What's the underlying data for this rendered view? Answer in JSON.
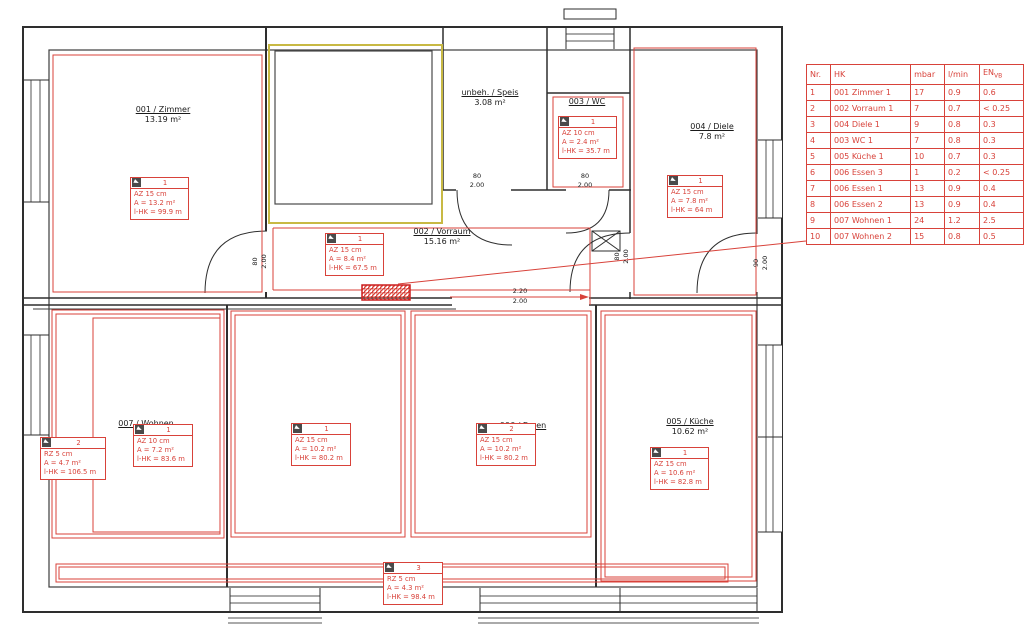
{
  "colors": {
    "annotation_red": "#d8423a",
    "unheated_yellow": "#c8b944",
    "wall_dark": "#2e2e2e"
  },
  "rooms": {
    "zimmer": {
      "name": "001 / Zimmer",
      "area": "13.19 m²"
    },
    "speis": {
      "name": "unbeh. / Speis",
      "area": "3.08 m²"
    },
    "wc": {
      "name": "003 / WC"
    },
    "diele": {
      "name": "004 / Diele",
      "area": "7.8 m²"
    },
    "vorraum": {
      "name": "002 / Vorraum",
      "area": "15.16 m²"
    },
    "wohnen": {
      "name": "007 / Wohnen"
    },
    "essen": {
      "name": "006 / Essen"
    },
    "kueche": {
      "name": "005 / Küche",
      "area": "10.62 m²"
    }
  },
  "hk_boxes": [
    {
      "no": "1",
      "line1": "AZ 15 cm",
      "line2": "A = 13.2 m²",
      "line3": "l-HK = 99.9 m"
    },
    {
      "no": "1",
      "line1": "AZ 10 cm",
      "line2": "A = 2.4 m²",
      "line3": "l-HK = 35.7 m"
    },
    {
      "no": "1",
      "line1": "AZ 15 cm",
      "line2": "A = 7.8 m²",
      "line3": "l-HK = 64 m"
    },
    {
      "no": "1",
      "line1": "AZ 15 cm",
      "line2": "A = 8.4 m²",
      "line3": "l-HK = 67.5 m"
    },
    {
      "no": "2",
      "line1": "RZ 5 cm",
      "line2": "A = 4.7 m²",
      "line3": "l-HK = 106.5 m"
    },
    {
      "no": "1",
      "line1": "AZ 10 cm",
      "line2": "A = 7.2 m²",
      "line3": "l-HK = 83.6 m"
    },
    {
      "no": "1",
      "line1": "AZ 15 cm",
      "line2": "A = 10.2 m²",
      "line3": "l-HK = 80.2 m"
    },
    {
      "no": "2",
      "line1": "AZ 15 cm",
      "line2": "A = 10.2 m²",
      "line3": "l-HK = 80.2 m"
    },
    {
      "no": "1",
      "line1": "AZ 15 cm",
      "line2": "A = 10.6 m²",
      "line3": "l-HK = 82.8 m"
    },
    {
      "no": "3",
      "line1": "RZ 5 cm",
      "line2": "A = 4.3 m²",
      "line3": "l-HK = 98.4 m"
    }
  ],
  "dims": {
    "speis_door": {
      "w": "80",
      "h": "2.00"
    },
    "wc_door": {
      "w": "80",
      "h": "2.00"
    },
    "zimmer_door": {
      "w": "80",
      "h": "2.00"
    },
    "diele_door": {
      "w": "80",
      "h": "2.00"
    },
    "entry_door": {
      "w": "90",
      "h": "2.00"
    },
    "passage": {
      "w": "2.20",
      "h": "2.00"
    }
  },
  "hk_table": {
    "headers": {
      "nr": "Nr.",
      "hk": "HK",
      "mbar": "mbar",
      "lmin": "l/min",
      "en_main": "EN",
      "en_sub": "VB"
    },
    "rows": [
      {
        "c0": "1",
        "c1": "001  Zimmer 1",
        "c2": "17",
        "c3": "0.9",
        "c4": "0.6"
      },
      {
        "c0": "2",
        "c1": "002  Vorraum 1",
        "c2": "7",
        "c3": "0.7",
        "c4": "< 0.25"
      },
      {
        "c0": "3",
        "c1": "004  Diele 1",
        "c2": "9",
        "c3": "0.8",
        "c4": "0.3"
      },
      {
        "c0": "4",
        "c1": "003  WC 1",
        "c2": "7",
        "c3": "0.8",
        "c4": "0.3"
      },
      {
        "c0": "5",
        "c1": "005  Küche 1",
        "c2": "10",
        "c3": "0.7",
        "c4": "0.3"
      },
      {
        "c0": "6",
        "c1": "006  Essen 3",
        "c2": "1",
        "c3": "0.2",
        "c4": "< 0.25"
      },
      {
        "c0": "7",
        "c1": "006  Essen 1",
        "c2": "13",
        "c3": "0.9",
        "c4": "0.4"
      },
      {
        "c0": "8",
        "c1": "006  Essen 2",
        "c2": "13",
        "c3": "0.9",
        "c4": "0.4"
      },
      {
        "c0": "9",
        "c1": "007  Wohnen 1",
        "c2": "24",
        "c3": "1.2",
        "c4": "2.5"
      },
      {
        "c0": "10",
        "c1": "007  Wohnen 2",
        "c2": "15",
        "c3": "0.8",
        "c4": "0.5"
      }
    ]
  }
}
